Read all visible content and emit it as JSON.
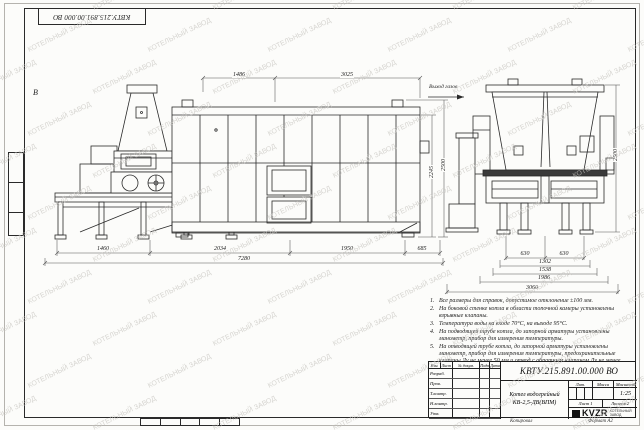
{
  "sheet": {
    "stamp_top_left": "КВТУ.215.891.00.000 ВО",
    "view_letter": "В",
    "watermark_text": "КОТЕЛЬНЫЙ ЗАВОД",
    "copied_label": "Копировал",
    "format_label": "Формат А2"
  },
  "drawing": {
    "gas_outlet_label": "Выход газов",
    "front_view": {
      "dims_top": [
        "1486",
        "3025"
      ],
      "dims_right": [
        "2245",
        "2500"
      ],
      "dims_bottom": [
        "1460",
        "2034",
        "1950",
        "685"
      ],
      "dim_overall": "7280"
    },
    "end_view": {
      "dims_bottom": [
        "630",
        "630",
        "1302",
        "1538",
        "1986",
        "3060"
      ],
      "dim_right": "2500"
    }
  },
  "notes": {
    "items": [
      "Все размеры для справок, допустимое отклонение ±100 мм.",
      "На боковой стенке котла в области топочной камеры установлены взрывные клапаны.",
      "Температура воды на входе 70°С, на выходе 95°С.",
      "На подводящей трубе котла, до запорной арматуры установлены манометр, прибор для измерения температуры.",
      "На отводящей трубе котла, до запорной арматуры установлены манометр, прибор для измерения температуры, предохранительные клапаны Ду не менее 50 мм и отвод с обратным клапаном Ду не менее 50 мм."
    ]
  },
  "title_block": {
    "designation": "КВТУ.215.891.00.000 ВО",
    "product_name_line1": "Котел водогрейный",
    "product_name_line2": "КВ-2,5-ДВ(ВПМ)",
    "header_cells": [
      "Изм.",
      "Лист",
      "№ докум.",
      "Подп.",
      "Дата"
    ],
    "rows": [
      "Разраб.",
      "Пров.",
      "Т.контр.",
      "Н.контр.",
      "Утв."
    ],
    "lit_label": "Лит.",
    "mass_label": "Масса",
    "scale_label": "Масштаб",
    "scale_value": "1:25",
    "sheet_text": "Лист 1",
    "sheets_text": "Листов 2",
    "logo_text": "KVZR",
    "logo_sub1": "КОТЕЛЬНЫЙ",
    "logo_sub2": "ЗАВОД"
  }
}
